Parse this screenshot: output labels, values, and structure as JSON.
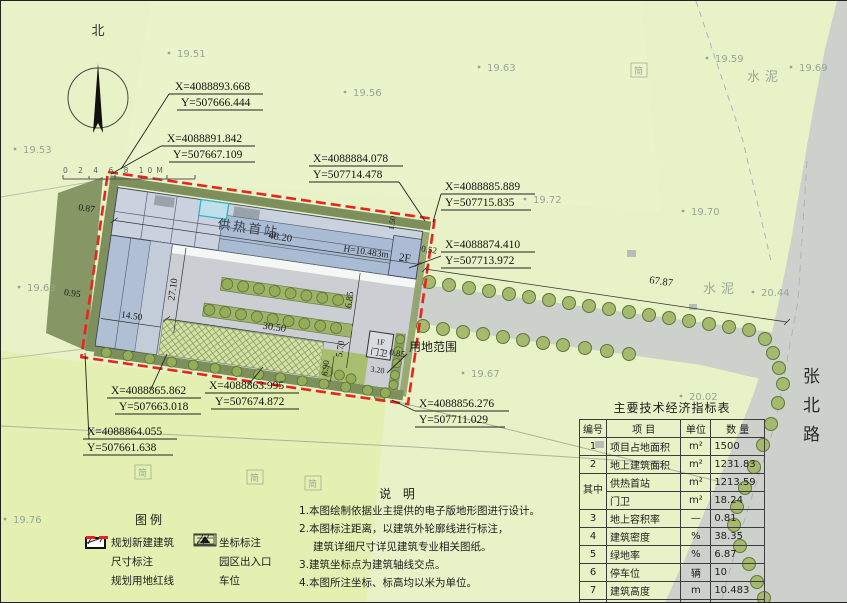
{
  "compass": {
    "north": "北",
    "scale": "0  2  4  6  8  10M"
  },
  "map_labels": {
    "building": "供热首站",
    "building_floor": "2F",
    "building_height": "H=10.483m",
    "guard": "门卫",
    "guard_floor": "1F",
    "land_scope": "用地范围",
    "road": "张北路",
    "cement": "水泥",
    "shed": "简"
  },
  "dimensions": {
    "building_length": "48.20",
    "apron_width": "30.50",
    "wing_length": "27.10",
    "wing_width": "14.50",
    "gap_east_upper": "6.85",
    "gap_east_lower": "5.70",
    "gap_guard": "6.90",
    "guard_width": "3.20",
    "gap_ne": "0.52",
    "gap_ne_top": "1.50",
    "gap_w_top": "0.87",
    "gap_w_bottom": "0.95",
    "gap_se": "0.85",
    "road_length": "67.87"
  },
  "coordinates": [
    {
      "x": "X=4088893.668",
      "y": "Y=507666.444"
    },
    {
      "x": "X=4088891.842",
      "y": "Y=507667.109"
    },
    {
      "x": "X=4088884.078",
      "y": "Y=507714.478"
    },
    {
      "x": "X=4088885.889",
      "y": "Y=507715.835"
    },
    {
      "x": "X=4088874.410",
      "y": "Y=507713.972"
    },
    {
      "x": "X=4088865.862",
      "y": "Y=507663.018"
    },
    {
      "x": "X=4088863.995",
      "y": "Y=507674.872"
    },
    {
      "x": "X=4088864.055",
      "y": "Y=507661.638"
    },
    {
      "x": "X=4088856.276",
      "y": "Y=507711.029"
    }
  ],
  "elevations": [
    "19.51",
    "19.59",
    "19.69",
    "19.56",
    "19.63",
    "19.53",
    "19.72",
    "19.70",
    "19.63",
    "19.67",
    "19.76",
    "20.02",
    "20.44"
  ],
  "table": {
    "title": "主要技术经济指标表",
    "headers": [
      "编号",
      "项  目",
      "单位",
      "数  量"
    ],
    "rows": [
      {
        "no": "1",
        "item": "项目占地面积",
        "unit": "m²",
        "qty": "1500"
      },
      {
        "no": "2",
        "item": "地上建筑面积",
        "unit": "m²",
        "qty": "1231.83"
      },
      {
        "no": "其中",
        "item": "供热首站",
        "unit": "m²",
        "qty": "1213.59"
      },
      {
        "no": "",
        "item": "门卫",
        "unit": "m²",
        "qty": "18.24"
      },
      {
        "no": "3",
        "item": "地上容积率",
        "unit": "—",
        "qty": "0.81"
      },
      {
        "no": "4",
        "item": "建筑密度",
        "unit": "%",
        "qty": "38.35"
      },
      {
        "no": "5",
        "item": "绿地率",
        "unit": "%",
        "qty": "6.87"
      },
      {
        "no": "6",
        "item": "停车位",
        "unit": "辆",
        "qty": "10"
      },
      {
        "no": "7",
        "item": "建筑高度",
        "unit": "m",
        "qty": "10.483"
      },
      {
        "no": "8",
        "item": "建筑层数",
        "unit": "层",
        "qty": "2"
      }
    ]
  },
  "notes": {
    "title": "说  明",
    "lines": [
      "1.本图绘制依据业主提供的电子版地形图进行设计。",
      "2.本图标注距离，以建筑外轮廓线进行标注，",
      "建筑详细尺寸详见建筑专业相关图纸。",
      "3.建筑坐标点为建筑轴线交点。",
      "4.本图所注坐标、标高均以米为单位。"
    ]
  },
  "legend": {
    "title": "图例",
    "items": [
      "规划新建建筑",
      "尺寸标注",
      "规划用地红线",
      "坐标标注",
      "园区出入口",
      "车位"
    ]
  }
}
